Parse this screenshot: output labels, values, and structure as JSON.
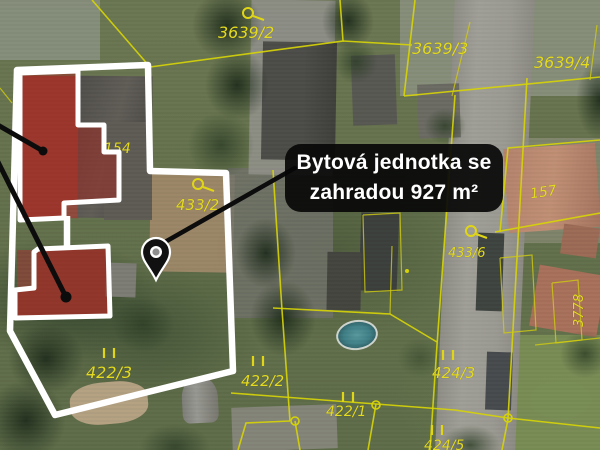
{
  "map": {
    "callout_label": {
      "line1": "Bytová jednotka se",
      "line2": "zahradou 927 m²"
    },
    "parcels": [
      {
        "text": "3639/2"
      },
      {
        "text": "3639/3"
      },
      {
        "text": "3639/4"
      },
      {
        "text": "154"
      },
      {
        "text": "433/2"
      },
      {
        "text": "433/6"
      },
      {
        "text": "157"
      },
      {
        "text": "3778"
      },
      {
        "text": "422/3"
      },
      {
        "text": "422/2"
      },
      {
        "text": "422/1"
      },
      {
        "text": "424/3"
      },
      {
        "text": "424/5"
      }
    ],
    "colors": {
      "parcel_line_yellow": "#d6d208",
      "parcel_label_yellow": "#e4da20",
      "property_outline_white": "#ffffff",
      "highlight_overlay_red": "#a81e18",
      "callout_background_black": "#080808",
      "callout_text_white": "#ffffff",
      "pin_black": "#111111"
    }
  }
}
